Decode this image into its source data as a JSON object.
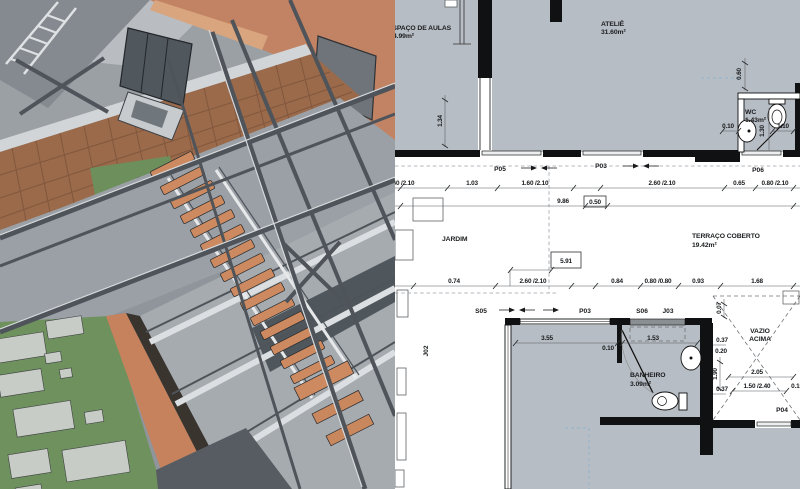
{
  "palette": {
    "plan_room_fill": "#b7bdc4",
    "plan_wall": "#101112",
    "model_bg": "#9ba0a5",
    "terracotta": "#c28364",
    "terracotta_dark": "#9c6147",
    "terracotta_light": "#d8a57e",
    "wood_deck": "#9a6a4b",
    "steel": "#4e545a",
    "steel_light": "#d7dadd",
    "floor_gray": "#9aa0a5",
    "floor_gray_dark": "#8f959b",
    "glass_dark": "#50575d",
    "green": "#6d8f5c",
    "green_yard": "#6f915e",
    "paver": "#c8ccc7",
    "stair_tread": "#cd8a60",
    "orange_wall_strip": "#c6825d",
    "shadow_dark": "#3a342f"
  },
  "plan": {
    "rooms": [
      {
        "name": "ESPAÇO DE AULAS",
        "area": "4.99m²"
      },
      {
        "name": "ATELIÊ",
        "area": "31.60m²"
      },
      {
        "name": "WC",
        "area": "1.43m²"
      },
      {
        "name": "JARDIM",
        "area": ""
      },
      {
        "name": "TERRAÇO COBERTO",
        "area": "19.42m²"
      },
      {
        "name": "BANHEIRO",
        "area": "3.09m²"
      },
      {
        "name": "VAZIO",
        "name2": "ACIMA"
      }
    ],
    "openings": [
      "P05",
      "P03",
      "P06",
      "S05",
      "P03",
      "S06",
      "J03",
      "J02",
      "P04"
    ],
    "dims": [
      "0.60",
      "1.34",
      "0.60 /2.10",
      "1.03",
      "1.60 /2.10",
      "2.60 /2.10",
      "0.65",
      "0.80 /2.10",
      "9.86",
      "0.50",
      "0.10",
      "1.30",
      "1.10",
      "5.91",
      "0.74",
      "2.60 /2.10",
      "0.84",
      "0.80 /0.80",
      "0.93",
      "1.68",
      "3.55",
      "0.10",
      "1.53",
      "0.07",
      "0.37",
      "0.20",
      "1.90",
      "0.37",
      "2.05",
      "1.50 /2.40",
      "0.15"
    ]
  }
}
